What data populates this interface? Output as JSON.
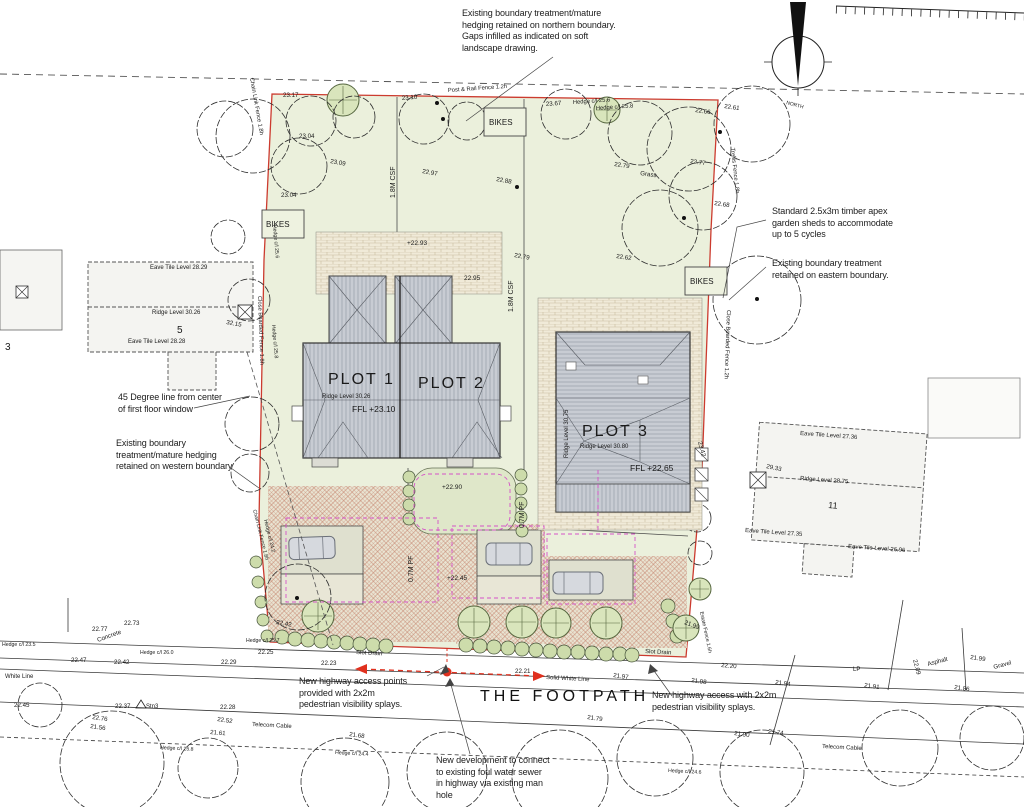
{
  "road_name": {
    "text": "THE FOOTPATH"
  },
  "north_label": "NORTH",
  "annotations": {
    "north_boundary": [
      "Existing boundary treatment/mature",
      "hedging retained on northern boundary.",
      "Gaps infilled as indicated on soft",
      "landscape drawing."
    ],
    "sheds": [
      "Standard 2.5x3m timber apex",
      "garden sheds to accommodate",
      "up to 5 cycles"
    ],
    "east_boundary": [
      "Existing boundary treatment",
      "retained on eastern boundary."
    ],
    "degree_line": [
      "45 Degree line from center",
      "of first floor window"
    ],
    "west_boundary": [
      "Existing boundary",
      "treatment/mature hedging",
      "retained on western boundary"
    ],
    "access_points": [
      "New highway access points",
      "provided with 2x2m",
      "pedestrian visibility splays."
    ],
    "access_east": [
      "New highway access with 2x2m",
      "pedestrian visibility splays."
    ],
    "sewer": [
      "New development to connect",
      "to existing foul water sewer",
      "in highway via existing man",
      "hole"
    ]
  },
  "plots": [
    {
      "name": "PLOT 1",
      "ridge": "Ridge Level 30.26",
      "ffl": "FFL +23.10"
    },
    {
      "name": "PLOT 2"
    },
    {
      "name": "PLOT 3",
      "ridge": "Ridge Level 30.80",
      "ridge_side": "Ridge Level 30.75",
      "ffl": "FFL +22.65"
    }
  ],
  "existing_houses": [
    {
      "number": "5",
      "eave_top": "Eave Tile Level 28.29",
      "ridge": "Ridge Level 30.26",
      "eave_bottom": "Eave Tile Level 28.28"
    },
    {
      "number": "11",
      "eave_top": "Eave Tile Level 27.36",
      "ridge": "Ridge Level 28.75",
      "eave_bottom_left": "Eave Tile Level 27.35",
      "eave_bottom_right": "Eave Tile Level 26.96"
    },
    {
      "number": "3"
    }
  ],
  "svg_labels": [
    {
      "n": "spot-level",
      "t": "23.17",
      "x": 283,
      "y": 97
    },
    {
      "n": "spot-level",
      "t": "23.10",
      "x": 402,
      "y": 100,
      "r": -5
    },
    {
      "n": "fence-label",
      "t": "Post & Rail Fence 1.2h",
      "x": 448,
      "y": 92,
      "r": -4,
      "s": 5.8
    },
    {
      "n": "spot-level",
      "t": "23.67",
      "x": 546,
      "y": 106,
      "r": -4
    },
    {
      "n": "hedge-label",
      "t": "Hedge c/l 25.6",
      "x": 573,
      "y": 104,
      "r": -4,
      "s": 5.8
    },
    {
      "n": "hedge-label",
      "t": "Hedge c/l 25.8",
      "x": 596,
      "y": 110,
      "r": -4,
      "s": 5.8
    },
    {
      "n": "spot-level",
      "t": "22.66",
      "x": 695,
      "y": 112,
      "r": 8
    },
    {
      "n": "spot-level",
      "t": "22.61",
      "x": 724,
      "y": 108,
      "r": 8
    },
    {
      "n": "spot-level",
      "t": "23.04",
      "x": 299,
      "y": 138
    },
    {
      "n": "spot-level",
      "t": "23.09",
      "x": 330,
      "y": 163,
      "r": 10
    },
    {
      "n": "spot-level",
      "t": "22.97",
      "x": 422,
      "y": 173,
      "r": 10
    },
    {
      "n": "spot-level",
      "t": "22.88",
      "x": 496,
      "y": 181,
      "r": 10
    },
    {
      "n": "spot-level",
      "t": "23.04",
      "x": 281,
      "y": 197
    },
    {
      "n": "spot-level",
      "t": "22.79",
      "x": 614,
      "y": 166,
      "r": 8
    },
    {
      "n": "surface-label",
      "t": "Grass",
      "x": 640,
      "y": 175,
      "r": 8
    },
    {
      "n": "spot-level",
      "t": "22.77",
      "x": 690,
      "y": 163,
      "r": 8
    },
    {
      "n": "spot-level",
      "t": "22.68",
      "x": 714,
      "y": 205,
      "r": 8
    },
    {
      "n": "spot-level",
      "t": "22.62",
      "x": 616,
      "y": 258,
      "r": 8
    },
    {
      "n": "fence-label",
      "t": "Trellis Fence 1.8h",
      "x": 731,
      "y": 148,
      "r": 84,
      "s": 5.8
    },
    {
      "n": "fence-label",
      "t": "Chain Link Fence 1.8h",
      "x": 250,
      "y": 78,
      "r": 80,
      "s": 5.8
    },
    {
      "n": "fence-label",
      "t": "1.8M CSF",
      "x": 395,
      "y": 198,
      "r": -90,
      "s": 7
    },
    {
      "n": "fence-label",
      "t": "1.8M CSF",
      "x": 513,
      "y": 312,
      "r": -90,
      "s": 7
    },
    {
      "n": "spot-level",
      "t": "+22.93",
      "x": 407,
      "y": 245,
      "s": 6.5
    },
    {
      "n": "spot-level",
      "t": "22.95",
      "x": 464,
      "y": 280,
      "s": 6.5
    },
    {
      "n": "spot-level",
      "t": "22.79",
      "x": 514,
      "y": 257,
      "r": 10
    },
    {
      "n": "fence-label",
      "t": "Close Boarded Fence 1.8h",
      "x": 258,
      "y": 296,
      "r": 88,
      "s": 5.8
    },
    {
      "n": "fence-label",
      "t": "Close Boarded Fence 1.2h",
      "x": 727,
      "y": 310,
      "r": 92,
      "s": 5.8
    },
    {
      "n": "hedge-label",
      "t": "Hedge c/l 25.6",
      "x": 273,
      "y": 225,
      "r": 85,
      "s": 5.2
    },
    {
      "n": "hedge-label",
      "t": "Hedge c/l 25.8",
      "x": 272,
      "y": 325,
      "r": 85,
      "s": 5.2
    },
    {
      "n": "spot-level",
      "t": "+22.90",
      "x": 442,
      "y": 489,
      "s": 6.5
    },
    {
      "n": "fence-label",
      "t": "0.7M PF",
      "x": 524,
      "y": 528,
      "r": -90,
      "s": 7
    },
    {
      "n": "fence-label",
      "t": "0.7M PF",
      "x": 413,
      "y": 582,
      "r": -90,
      "s": 7
    },
    {
      "n": "spot-level",
      "t": "+22.45",
      "x": 447,
      "y": 580,
      "s": 6.5
    },
    {
      "n": "spot-level",
      "t": "23.42",
      "x": 698,
      "y": 442,
      "r": 75
    },
    {
      "n": "fence-label",
      "t": "Chain Link Fence 1.8h",
      "x": 253,
      "y": 510,
      "r": 76,
      "s": 5.2
    },
    {
      "n": "hedge-label",
      "t": "Hedge c/l 24.2",
      "x": 264,
      "y": 520,
      "r": 76,
      "s": 5.2
    },
    {
      "n": "hedge-label",
      "t": "Hedge c/l 25.7",
      "x": 246,
      "y": 642,
      "s": 5.2
    },
    {
      "n": "spot-level",
      "t": "22.25",
      "x": 258,
      "y": 654
    },
    {
      "n": "spot-level",
      "t": "22.42",
      "x": 276,
      "y": 624,
      "r": 10
    },
    {
      "n": "spot-level",
      "t": "21.99",
      "x": 684,
      "y": 624,
      "r": 20
    },
    {
      "n": "fence-label",
      "t": "Estate Fence 1.6h",
      "x": 700,
      "y": 612,
      "r": 78,
      "s": 5.2
    },
    {
      "n": "spot-level",
      "t": "22.20",
      "x": 721,
      "y": 667,
      "r": 5
    },
    {
      "n": "drainage-label",
      "t": "Slot Drain",
      "x": 356,
      "y": 654,
      "r": 3,
      "s": 6
    },
    {
      "n": "drainage-label",
      "t": "Slot Drain",
      "x": 645,
      "y": 653,
      "r": 3,
      "s": 6
    },
    {
      "n": "spot-level",
      "t": "22.77",
      "x": 92,
      "y": 631
    },
    {
      "n": "surface-label",
      "t": "Concrete",
      "x": 98,
      "y": 642,
      "r": -20
    },
    {
      "n": "spot-level",
      "t": "22.73",
      "x": 124,
      "y": 625
    },
    {
      "n": "hedge-label",
      "t": "Hedge c/l 23.5",
      "x": 2,
      "y": 646,
      "s": 5.2
    },
    {
      "n": "spot-level",
      "t": "22.47",
      "x": 71,
      "y": 662
    },
    {
      "n": "spot-level",
      "t": "22.42",
      "x": 114,
      "y": 664
    },
    {
      "n": "hedge-label",
      "t": "Hedge c/l 26.0",
      "x": 140,
      "y": 654,
      "s": 5.2
    },
    {
      "n": "spot-level",
      "t": "22.29",
      "x": 221,
      "y": 664
    },
    {
      "n": "road-label",
      "t": "White Line",
      "x": 5,
      "y": 678,
      "s": 6
    },
    {
      "n": "spot-level",
      "t": "22.23",
      "x": 321,
      "y": 665
    },
    {
      "n": "spot-level",
      "t": "22.21",
      "x": 515,
      "y": 673
    },
    {
      "n": "road-label",
      "t": "Solid White Line",
      "x": 546,
      "y": 679,
      "r": 3,
      "s": 6
    },
    {
      "n": "spot-level",
      "t": "21.97",
      "x": 613,
      "y": 677,
      "r": 8
    },
    {
      "n": "spot-level",
      "t": "21.98",
      "x": 691,
      "y": 682,
      "r": 8
    },
    {
      "n": "spot-level",
      "t": "21.94",
      "x": 775,
      "y": 684,
      "r": 8
    },
    {
      "n": "spot-level",
      "t": "21.91",
      "x": 864,
      "y": 687,
      "r": 8
    },
    {
      "n": "utility-label",
      "t": "LP",
      "x": 853,
      "y": 671,
      "s": 6
    },
    {
      "n": "spot-level",
      "t": "22.09",
      "x": 913,
      "y": 660,
      "r": 75
    },
    {
      "n": "surface-label",
      "t": "Asphalt",
      "x": 928,
      "y": 666,
      "r": -15
    },
    {
      "n": "spot-level",
      "t": "21.99",
      "x": 970,
      "y": 659,
      "r": 8
    },
    {
      "n": "surface-label",
      "t": "Gravel",
      "x": 994,
      "y": 669,
      "r": -15
    },
    {
      "n": "spot-level",
      "t": "21.86",
      "x": 954,
      "y": 689,
      "r": 8
    },
    {
      "n": "spot-level",
      "t": "22.45",
      "x": 14,
      "y": 707
    },
    {
      "n": "spot-level",
      "t": "22.37",
      "x": 115,
      "y": 708
    },
    {
      "n": "survey-label",
      "t": "Stn3",
      "x": 146,
      "y": 708,
      "s": 6
    },
    {
      "n": "spot-level",
      "t": "22.28",
      "x": 220,
      "y": 709
    },
    {
      "n": "spot-level",
      "t": "22.76",
      "x": 92,
      "y": 719,
      "r": 8
    },
    {
      "n": "spot-level",
      "t": "21.56",
      "x": 90,
      "y": 728,
      "r": 8
    },
    {
      "n": "spot-level",
      "t": "22.52",
      "x": 217,
      "y": 721,
      "r": 8
    },
    {
      "n": "utility-label",
      "t": "Telecom Cable",
      "x": 252,
      "y": 726,
      "r": 3,
      "s": 6
    },
    {
      "n": "spot-level",
      "t": "21.61",
      "x": 210,
      "y": 734,
      "r": 5
    },
    {
      "n": "hedge-label",
      "t": "Hedge c/l 25.8",
      "x": 160,
      "y": 749,
      "r": 3,
      "s": 5.2
    },
    {
      "n": "spot-level",
      "t": "21.68",
      "x": 349,
      "y": 736,
      "r": 8
    },
    {
      "n": "hedge-label",
      "t": "Hedge c/l 24.4",
      "x": 335,
      "y": 754,
      "r": 3,
      "s": 5.2
    },
    {
      "n": "spot-level",
      "t": "21.79",
      "x": 587,
      "y": 719,
      "r": 8
    },
    {
      "n": "hedge-label",
      "t": "Hedge c/l 24.6",
      "x": 668,
      "y": 772,
      "r": 3,
      "s": 5.2
    },
    {
      "n": "spot-level",
      "t": "21.90",
      "x": 734,
      "y": 735,
      "r": 8
    },
    {
      "n": "spot-level",
      "t": "21.74",
      "x": 768,
      "y": 733,
      "r": 8
    },
    {
      "n": "utility-label",
      "t": "Telecom Cable",
      "x": 822,
      "y": 748,
      "r": 3,
      "s": 6
    },
    {
      "n": "spot-level",
      "t": "29.33",
      "x": 766,
      "y": 468,
      "r": 12
    },
    {
      "n": "spot-level",
      "t": "32.15",
      "x": 226,
      "y": 324,
      "r": 10
    },
    {
      "n": "house-number",
      "t": "5",
      "x": 177,
      "y": 333,
      "s": 10
    },
    {
      "n": "house-number",
      "t": "11",
      "x": 828,
      "y": 508,
      "s": 9,
      "r": 5
    },
    {
      "n": "house-number",
      "t": "3",
      "x": 5,
      "y": 350,
      "s": 10
    },
    {
      "n": "level-label",
      "t": "Eave Tile Level 28.29",
      "x": 150,
      "y": 269,
      "s": 6
    },
    {
      "n": "level-label",
      "t": "Ridge Level 30.26",
      "x": 152,
      "y": 314,
      "s": 6
    },
    {
      "n": "level-label",
      "t": "Eave Tile Level 28.28",
      "x": 128,
      "y": 343,
      "s": 6
    },
    {
      "n": "level-label",
      "t": "Eave Tile Level 27.36",
      "x": 800,
      "y": 435,
      "r": 4,
      "s": 6
    },
    {
      "n": "level-label",
      "t": "Ridge Level 28.75",
      "x": 800,
      "y": 480,
      "r": 4,
      "s": 6
    },
    {
      "n": "level-label",
      "t": "Eave Tile Level 27.35",
      "x": 745,
      "y": 532,
      "r": 4,
      "s": 6
    },
    {
      "n": "level-label",
      "t": "Eave Tile Level 26.96",
      "x": 848,
      "y": 548,
      "r": 4,
      "s": 6
    },
    {
      "n": "plot-title",
      "t": "PLOT 1",
      "x": 328,
      "y": 384,
      "s": 16,
      "ls": 2
    },
    {
      "n": "plot-title",
      "t": "PLOT 2",
      "x": 418,
      "y": 388,
      "s": 16,
      "ls": 2
    },
    {
      "n": "plot-title",
      "t": "PLOT 3",
      "x": 582,
      "y": 436,
      "s": 16,
      "ls": 2
    },
    {
      "n": "level-label",
      "t": "Ridge Level 30.26",
      "x": 322,
      "y": 398,
      "s": 6
    },
    {
      "n": "ffl-label",
      "t": "FFL +23.10",
      "x": 352,
      "y": 412,
      "s": 8.5
    },
    {
      "n": "level-label",
      "t": "Ridge Level 30.80",
      "x": 580,
      "y": 448,
      "s": 6
    },
    {
      "n": "ffl-label",
      "t": "FFL +22.65",
      "x": 630,
      "y": 471,
      "s": 8.5
    },
    {
      "n": "level-label",
      "t": "Ridge Level 30.75",
      "x": 568,
      "y": 458,
      "r": -90,
      "s": 6
    },
    {
      "n": "bikes-label",
      "t": "BIKES",
      "x": 266,
      "y": 227,
      "s": 8
    },
    {
      "n": "bikes-label",
      "t": "BIKES",
      "x": 489,
      "y": 125,
      "s": 8
    },
    {
      "n": "bikes-label",
      "t": "BIKES",
      "x": 690,
      "y": 284,
      "s": 8
    },
    {
      "n": "north-label",
      "t": "NORTH",
      "x": 786,
      "y": 104,
      "r": 15,
      "s": 5
    }
  ]
}
